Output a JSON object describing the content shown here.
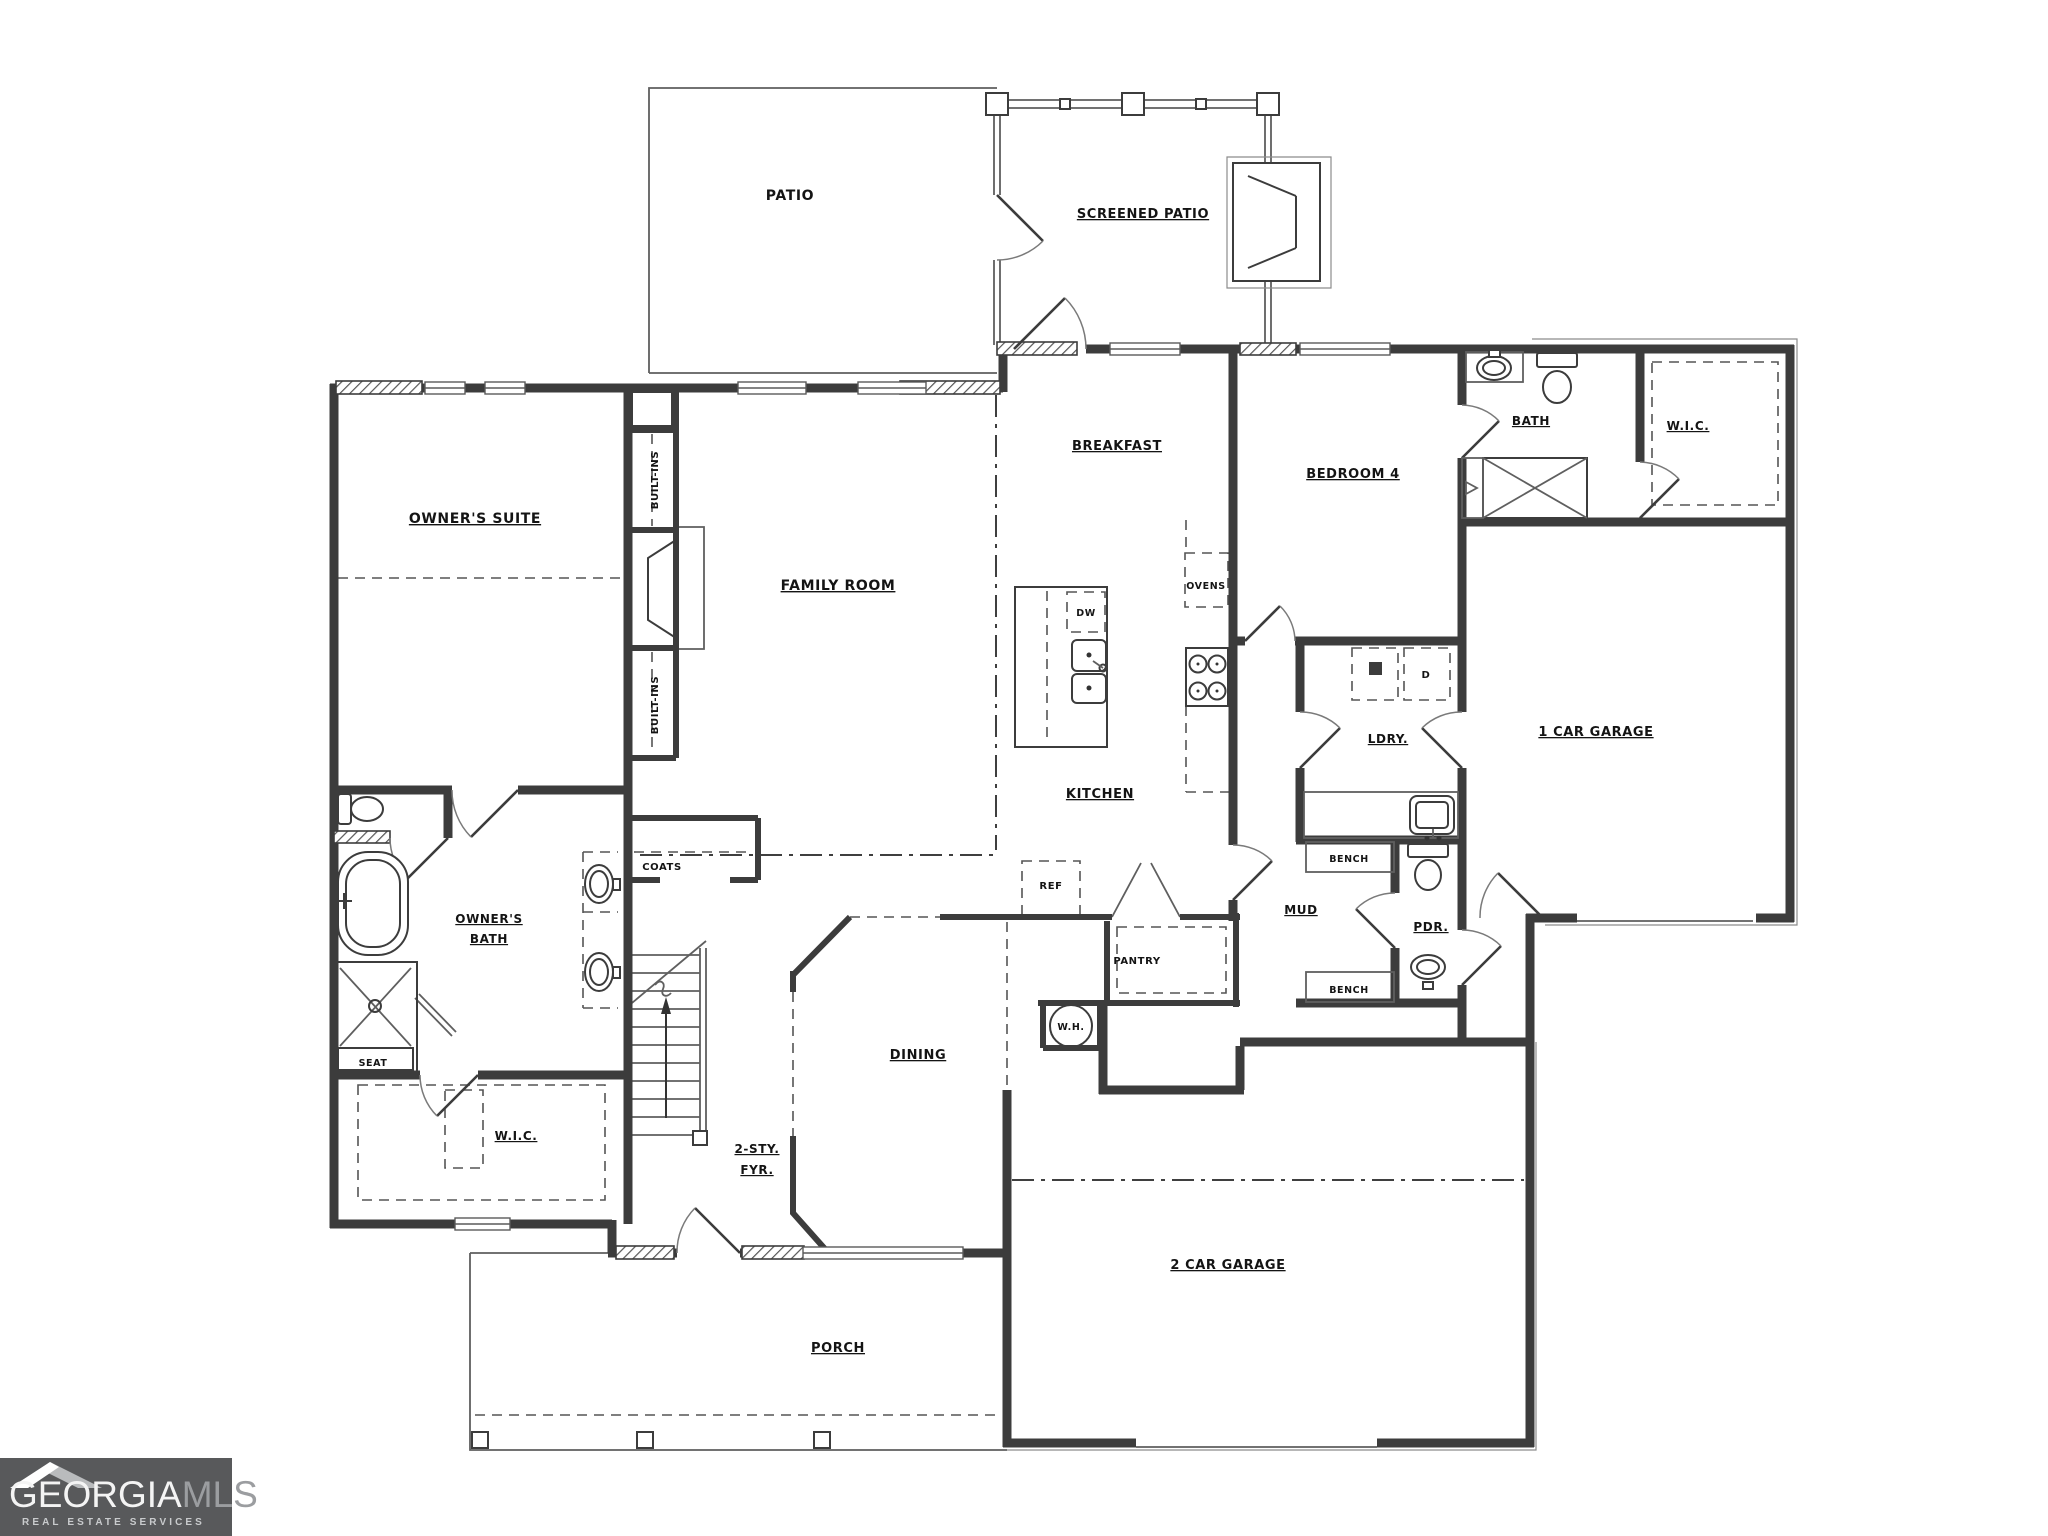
{
  "rooms": {
    "patio": "PATIO",
    "screened_patio": "SCREENED PATIO",
    "owners_suite": "OWNER'S SUITE",
    "family_room": "FAMILY ROOM",
    "breakfast": "BREAKFAST",
    "kitchen": "KITCHEN",
    "bedroom_4": "BEDROOM 4",
    "bath": "BATH",
    "wic_upper": "W.I.C.",
    "garage_1car": "1 CAR GARAGE",
    "laundry": "LDRY.",
    "mud": "MUD",
    "powder": "PDR.",
    "pantry": "PANTRY",
    "dining": "DINING",
    "foyer_line1": "2-STY.",
    "foyer_line2": "FYR.",
    "owners_bath_line1": "OWNER'S",
    "owners_bath_line2": "BATH",
    "wic_lower": "W.I.C.",
    "porch": "PORCH",
    "garage_2car": "2 CAR GARAGE"
  },
  "fixtures": {
    "built_ins_upper": "BUILT-INS",
    "built_ins_lower": "BUILT-INS",
    "ovens": "OVENS",
    "dishwasher": "DW",
    "refrigerator": "REF",
    "water_heater": "W.H.",
    "dryer": "D",
    "bench_upper": "BENCH",
    "bench_lower": "BENCH",
    "coats": "COATS",
    "seat": "SEAT"
  },
  "logo": {
    "brand_primary": "GEORGIA",
    "brand_secondary": "MLS",
    "tagline": "REAL ESTATE SERVICES"
  },
  "colors": {
    "wall": "#3c3c3c",
    "logo_background": "#58595b"
  }
}
